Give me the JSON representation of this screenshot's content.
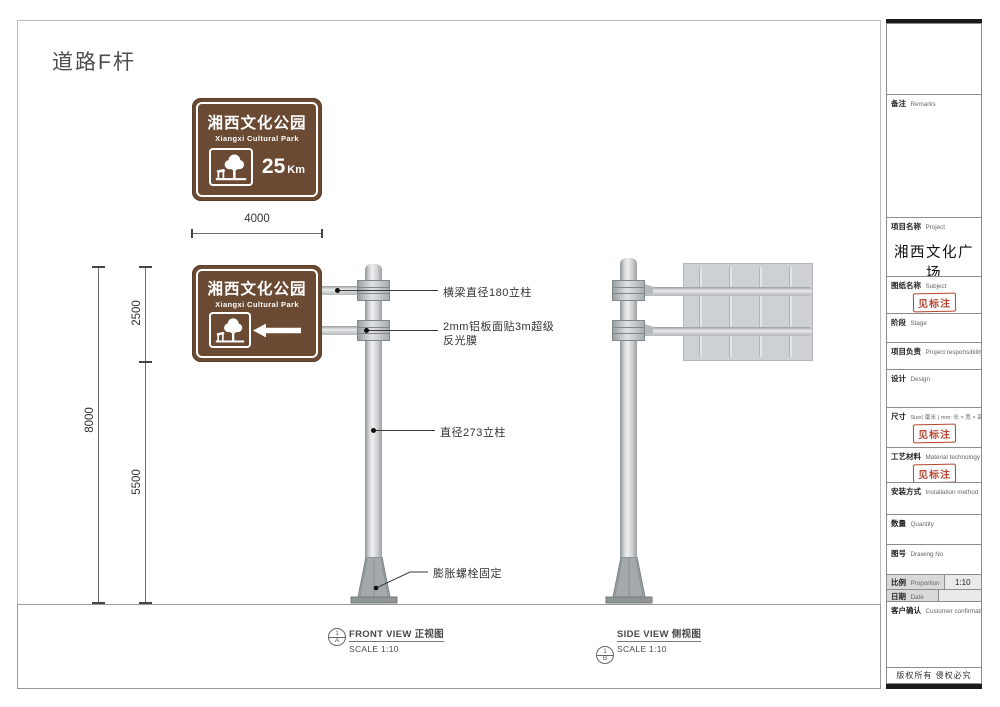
{
  "page_title": "道路F杆",
  "sign": {
    "title": "湘西文化公园",
    "subtitle": "Xiangxi Cultural Park",
    "distance": "25",
    "unit": "Km"
  },
  "dims": {
    "width": "4000",
    "upper": "2500",
    "lower": "5500",
    "total": "8000"
  },
  "annotations": {
    "beam": "横梁直径180立柱",
    "panel": [
      "2mm铝板面贴3m超级",
      "反光膜"
    ],
    "pole": "直径273立柱",
    "base": "膨胀螺栓固定"
  },
  "views": {
    "front": {
      "num": "1",
      "letter": "A",
      "name": "FRONT VIEW 正视图",
      "scale": "SCALE 1:10"
    },
    "side": {
      "num": "1",
      "letter": "B",
      "name": "SIDE VIEW  侧视图",
      "scale": "SCALE 1:10"
    }
  },
  "title_block": {
    "remarks": {
      "zh": "备注",
      "en": "Remarks"
    },
    "project": {
      "zh": "项目名称",
      "en": "Project",
      "value": "湘西文化广场"
    },
    "subject": {
      "zh": "图纸名称",
      "en": "Subject",
      "stamp": "见标注"
    },
    "stage": {
      "zh": "阶段",
      "en": "Stage"
    },
    "responsibility": {
      "zh": "项目负责",
      "en": "Project responsibility"
    },
    "design": {
      "zh": "设计",
      "en": "Design"
    },
    "size": {
      "zh": "尺寸",
      "en": "Size( 毫米 ) mm: 长 × 宽 × 高",
      "stamp": "见标注"
    },
    "material": {
      "zh": "工艺材料",
      "en": "Material technology",
      "stamp": "见标注"
    },
    "installation": {
      "zh": "安装方式",
      "en": "Installation method"
    },
    "quantity": {
      "zh": "数量",
      "en": "Quantity"
    },
    "drawing_no": {
      "zh": "图号",
      "en": "Drawing No"
    },
    "proportion": {
      "zh": "比例",
      "en": "Proportion",
      "value": "1:10"
    },
    "date": {
      "zh": "日期",
      "en": "Date",
      "value": ""
    },
    "confirmation": {
      "zh": "客户确认",
      "en": "Customer confirmation"
    },
    "copyright": "版权所有  侵权必究"
  },
  "colors": {
    "sign_brown": "#6b4a33",
    "stamp_red": "#b5442f",
    "pole_grey": "#c9cdcf",
    "panel_grey": "#ced1d3"
  }
}
